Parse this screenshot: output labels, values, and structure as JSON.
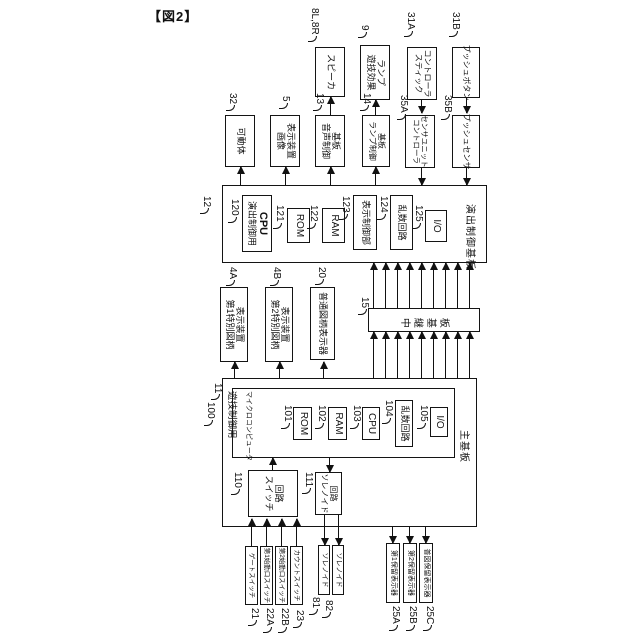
{
  "figure_label": "【図2】",
  "devices": {
    "speaker": {
      "ref": "8L,8R",
      "label": "スピーカ"
    },
    "lamp": {
      "ref": "9",
      "line1": "ランプ",
      "line2": "遊技効果"
    },
    "stick": {
      "ref": "31A",
      "line1": "コントローラ",
      "line2": "スティック"
    },
    "push_button": {
      "ref": "31B",
      "label": "プッシュボタン"
    },
    "movable": {
      "ref": "32",
      "label": "可動体"
    },
    "image_display": {
      "ref": "5",
      "line1": "表示装置",
      "line2": "画像"
    },
    "sound_board": {
      "ref": "13",
      "line1": "基板",
      "line2": "音声制御"
    },
    "lamp_board": {
      "ref": "14",
      "line1": "基板",
      "line2": "ランプ制御"
    },
    "controller_sensor": {
      "ref": "35A",
      "line1": "センサユニット",
      "line2": "コントローラ"
    },
    "push_sensor": {
      "ref": "35B",
      "label": "プッシュセンサ"
    }
  },
  "effect_board": {
    "ref": "12",
    "name": "演出制御基板",
    "cpu": {
      "ref": "120",
      "line1": "CPU",
      "line2": "演出制御用"
    },
    "rom": {
      "ref": "121",
      "label": "ROM"
    },
    "ram": {
      "ref": "122",
      "label": "RAM"
    },
    "display_ctrl": {
      "ref": "123",
      "label": "表示制御部"
    },
    "random": {
      "ref": "124",
      "label": "乱数回路"
    },
    "io": {
      "ref": "125",
      "label": "I/O"
    }
  },
  "symbol_displays": {
    "first_special": {
      "ref": "4A",
      "line1": "表示装置",
      "line2": "第1特別図柄"
    },
    "second_special": {
      "ref": "4B",
      "line1": "表示装置",
      "line2": "第2特別図柄"
    },
    "normal": {
      "ref": "20",
      "label": "普通図柄表示器"
    }
  },
  "relay_board": {
    "ref": "15",
    "name": "中継基板"
  },
  "main_board": {
    "ref": "11",
    "name": "主基板",
    "micom": {
      "ref": "100",
      "line1": "マイクロコンピュータ",
      "line2": "遊技制御用",
      "rom": {
        "ref": "101",
        "label": "ROM"
      },
      "ram": {
        "ref": "102",
        "label": "RAM"
      },
      "cpu": {
        "ref": "103",
        "label": "CPU"
      },
      "random": {
        "ref": "104",
        "label": "乱数回路"
      },
      "io": {
        "ref": "105",
        "label": "I/O"
      }
    },
    "switch_circuit": {
      "ref": "110",
      "line1": "回路",
      "line2": "スイッチ"
    },
    "solenoid_circuit": {
      "ref": "111",
      "line1": "回路",
      "line2": "ソレノイド"
    }
  },
  "inputs": {
    "gate_switch": {
      "ref": "21",
      "label": "ゲートスイッチ"
    },
    "first_start_switch": {
      "ref": "22A",
      "label": "第1始動口スイッチ"
    },
    "second_start_switch": {
      "ref": "22B",
      "label": "第2始動口スイッチ"
    },
    "count_switch": {
      "ref": "23",
      "label": "カウントスイッチ"
    }
  },
  "solenoids": {
    "solenoid_81": {
      "ref": "81",
      "label": "ソレノイド"
    },
    "solenoid_82": {
      "ref": "82",
      "label": "ソレノイド"
    }
  },
  "hold_displays": {
    "first_hold": {
      "ref": "25A",
      "label": "第1保留表示器"
    },
    "second_hold": {
      "ref": "25B",
      "label": "第2保留表示器"
    },
    "normal_hold": {
      "ref": "25C",
      "label": "普図保留表示器"
    }
  }
}
